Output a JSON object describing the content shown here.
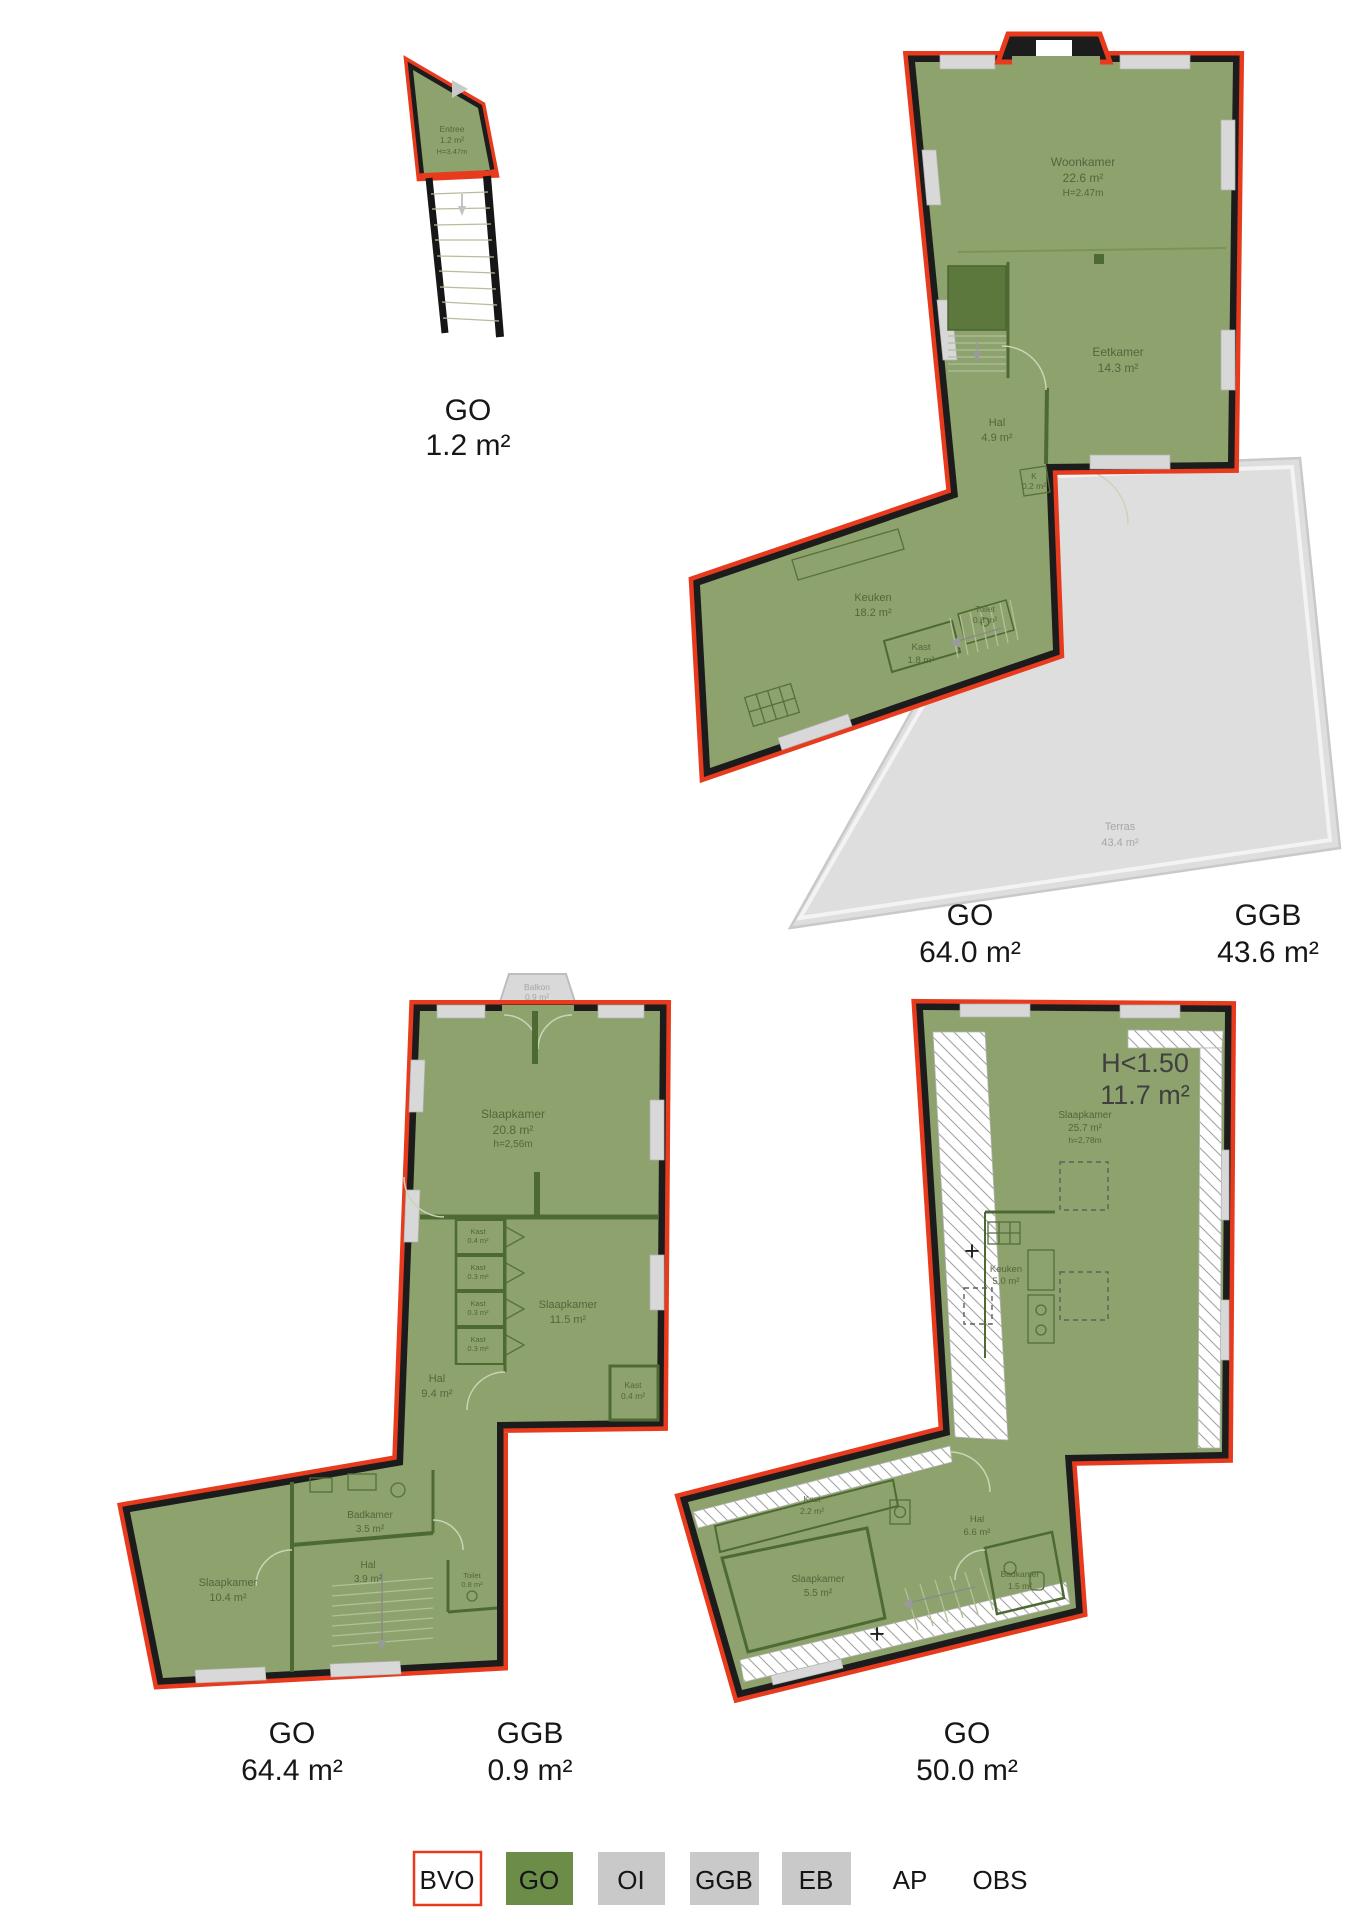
{
  "plan_entree": {
    "room": {
      "name": "Entree",
      "area": "1.2 m²",
      "height": "H=3.47m"
    },
    "label_go_type": "GO",
    "label_go_area": "1.2 m²"
  },
  "plan_first_floor": {
    "woonkamer": {
      "name": "Woonkamer",
      "area": "22.6 m²",
      "height": "H=2.47m"
    },
    "eetkamer": {
      "name": "Eetkamer",
      "area": "14.3 m²"
    },
    "hal": {
      "name": "Hal",
      "area": "4.9 m²"
    },
    "kast_klein": {
      "name": "K",
      "area": "0.2 m²"
    },
    "keuken": {
      "name": "Keuken",
      "area": "18.2 m²"
    },
    "kast": {
      "name": "Kast",
      "area": "1.8 m²"
    },
    "toilet": {
      "name": "Toilet",
      "area": "0.8 m²"
    },
    "terras": {
      "name": "Terras",
      "area": "43.4 m²"
    },
    "label_go_type": "GO",
    "label_go_area": "64.0 m²",
    "label_ggb_type": "GGB",
    "label_ggb_area": "43.6 m²"
  },
  "plan_second_floor": {
    "balkon": {
      "name": "Balkon",
      "area": "0.9 m²"
    },
    "slaapkamer_1": {
      "name": "Slaapkamer",
      "area": "20.8 m²",
      "height": "h=2,56m"
    },
    "kast_1": {
      "name": "Kast",
      "area": "0.4 m²"
    },
    "kast_2": {
      "name": "Kast",
      "area": "0.3 m²"
    },
    "kast_3": {
      "name": "Kast",
      "area": "0.3 m²"
    },
    "kast_4": {
      "name": "Kast",
      "area": "0.3 m²"
    },
    "slaapkamer_2": {
      "name": "Slaapkamer",
      "area": "11.5 m²"
    },
    "kast_5": {
      "name": "Kast",
      "area": "0.4 m²"
    },
    "hal": {
      "name": "Hal",
      "area": "9.4 m²"
    },
    "badkamer": {
      "name": "Badkamer",
      "area": "3.5 m²"
    },
    "hal_2": {
      "name": "Hal",
      "area": "3.9 m²"
    },
    "toilet": {
      "name": "Toilet",
      "area": "0.8 m²"
    },
    "slaapkamer_3": {
      "name": "Slaapkamer",
      "area": "10.4 m²"
    },
    "label_go_type": "GO",
    "label_go_area": "64.4 m²",
    "label_ggb_type": "GGB",
    "label_ggb_area": "0.9 m²"
  },
  "plan_third_floor": {
    "h_restriction": {
      "line1": "H<1.50",
      "line2": "11.7 m²"
    },
    "slaapkamer_1": {
      "name": "Slaapkamer",
      "area": "25.7 m²",
      "height": "h=2,78m"
    },
    "keuken": {
      "name": "Keuken",
      "area": "5.0 m²"
    },
    "kast": {
      "name": "Kast",
      "area": "2.2 m²"
    },
    "hal": {
      "name": "Hal",
      "area": "6.6 m²"
    },
    "slaapkamer_2": {
      "name": "Slaapkamer",
      "area": "5.5 m²"
    },
    "badkamer": {
      "name": "Badkamer",
      "area": "1.5 m²"
    },
    "plus_marker": "+",
    "label_go_type": "GO",
    "label_go_area": "50.0 m²"
  },
  "legend": {
    "items": [
      {
        "code": "BVO"
      },
      {
        "code": "GO"
      },
      {
        "code": "OI"
      },
      {
        "code": "GGB"
      },
      {
        "code": "EB"
      },
      {
        "code": "AP"
      },
      {
        "code": "OBS"
      }
    ]
  },
  "colors": {
    "go_fill": "#8da26c",
    "outline_red": "#e83b1e",
    "wall_black": "#1c1c1c",
    "interior_green": "#4e6a33",
    "grey_area": "#dedede",
    "legend_go": "#6b8d48",
    "legend_grey": "#c9c9c9"
  }
}
